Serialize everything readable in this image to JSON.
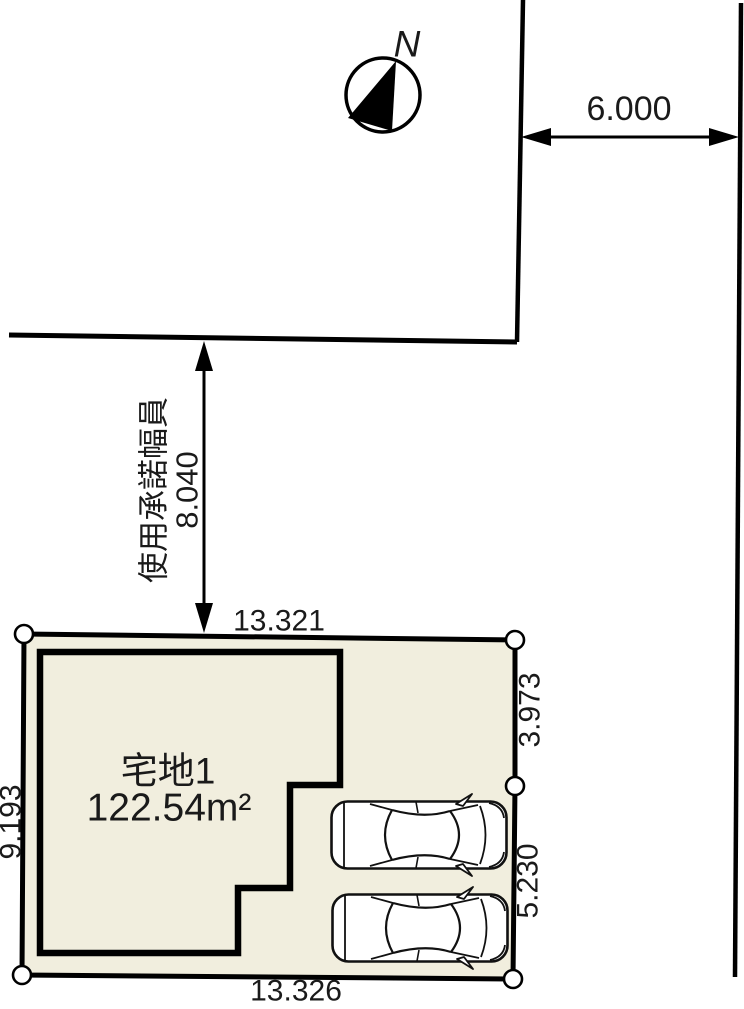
{
  "plan": {
    "compass": {
      "label": "N"
    },
    "road": {
      "width": "6.000"
    },
    "easement": {
      "label": "使用承諾幅員",
      "value": "8.040"
    },
    "lot": {
      "name": "宅地1",
      "area": "122.54m²",
      "dim_top": "13.321",
      "dim_bottom": "13.326",
      "dim_left": "9.193",
      "dim_right_upper": "3.973",
      "dim_right_lower": "5.230"
    },
    "colors": {
      "lot_fill": "#f1eede",
      "line": "#000000"
    },
    "cars_count": 2
  }
}
